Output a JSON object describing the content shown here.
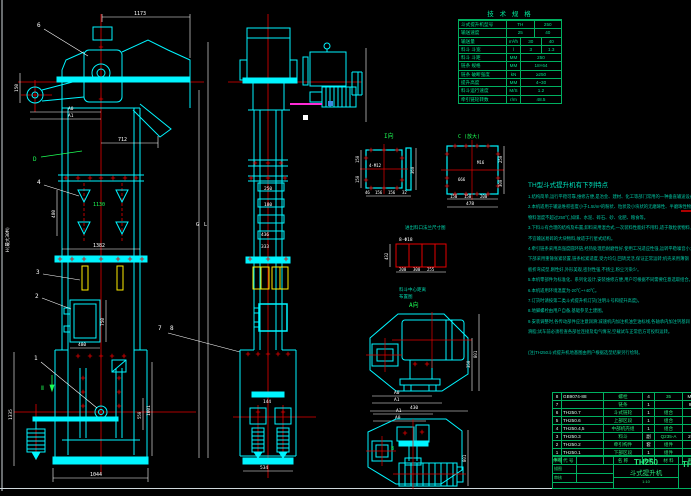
{
  "colors": {
    "cyan": "#00f5ff",
    "red": "#e60000",
    "green": "#1dff55",
    "yellow": "#ffee00",
    "magenta": "#ff2bd6",
    "teal": "#00d8ae",
    "table_green": "#00e08a"
  },
  "spec_table": {
    "title": "技 术 规 格",
    "rows": [
      {
        "l": "斗式提升机型号",
        "u": "",
        "v1": "TH",
        "v2": "250"
      },
      {
        "l": "输送速度",
        "u": "",
        "v1": "25",
        "v2": "40"
      },
      {
        "l": "输送量",
        "u": "m³/h",
        "v1": "30",
        "v2": "40"
      },
      {
        "l": "料斗 斗宽",
        "u": "l",
        "v1": "3",
        "v2": "1.3"
      },
      {
        "l": "料斗 斗距",
        "u": "MM",
        "v1": "250",
        "v2": ""
      },
      {
        "l": "链条 规格",
        "u": "MM",
        "v1": "18×64",
        "v2": ""
      },
      {
        "l": "链条 破断强度",
        "u": "kN",
        "v1": "≥250",
        "v2": ""
      },
      {
        "l": "提升高度",
        "u": "MM",
        "v1": "4~30",
        "v2": ""
      },
      {
        "l": "料斗运行速度",
        "u": "M/S",
        "v1": "1.2",
        "v2": ""
      },
      {
        "l": "牵引链轮转数",
        "u": "r/m",
        "v1": "48.5",
        "v2": ""
      }
    ]
  },
  "notes": {
    "title": "TH型斗式提升机有下列特点",
    "lines": [
      "1.结构简单,运行平稳可靠,维修方便,是冶金、建材、化工等部门常用的一种垂直输送设备。",
      "2.本机适用于输送堆积密度小于1.5t/m³的粉状、粒状及小块状的无磨琢性、半磨琢性物料,",
      "  物料温度不超过250℃,如煤、水泥、碎石、砂、化肥、粮食等。",
      "3.下料斗有合理的结构及布置,卸料采用混合式,一次装料性能好不甩料,适于散粒状物料,",
      "  不宜输送易碎的大块物料,故适于行星式结构。",
      "4.牵引链条采用高强度圆环链,经热处理后耐磨性好,使用工况适应性强,运转平稳噪音小;",
      "  下部采用重锤张紧装置,链条松紧适度,受力均匀,回转灵活,保证正常运转;机壳采用薄钢",
      "  板折弯成型,刚性好,外形美观,密封性强,不扬尘,粉尘污染少。",
      "5.本机零部件为标准化、系列化设计,安装维修方便,用户可根据不同需要任意选取组合。",
      "6.本机适用环境温度为-20℃~+40℃。",
      "7.订货时请按第二类斗式提升机订货(注明斗号和提升高度)。",
      "8.地脚螺栓由用户自备,基础参见土建图。",
      "9.安装调整时,各传动部件应注意润滑:减速机内加注机油至油标线,各轴承内加注钙基润",
      "  滑脂;试车前必须检查各部位连接及电气情况,空载试车正常后方可投料运转。",
      "",
      "(注)TH250斗式提升机地基图由用户根据选型结果另行绘制。"
    ]
  },
  "bom": {
    "header": {
      "no": "件号",
      "code": "代  号",
      "name": "名  称",
      "qty": "数量",
      "mat": "材  料",
      "wt": "重量"
    },
    "rows": [
      {
        "no": "8",
        "code": "GB9074-88",
        "name": "螺栓",
        "qty": "4",
        "mat": "35",
        "wt": "M20"
      },
      {
        "no": "7",
        "code": "",
        "name": "链条",
        "qty": "1",
        "mat": "",
        "wt": "9.0"
      },
      {
        "no": "6",
        "code": "TH250.7",
        "name": "斗式链轮",
        "qty": "1",
        "mat": "组合",
        "wt": ""
      },
      {
        "no": "5",
        "code": "TH250.6",
        "name": "上部区段",
        "qty": "1",
        "mat": "组合",
        "wt": ""
      },
      {
        "no": "4",
        "code": "TH250.4,5",
        "name": "中部机壳组",
        "qty": "1",
        "mat": "组合",
        "wt": ""
      },
      {
        "no": "3",
        "code": "TH250.3",
        "name": "料斗",
        "qty": "副",
        "mat": "Q235-A",
        "wt": "203"
      },
      {
        "no": "2",
        "code": "TH250.2",
        "name": "牵引构件",
        "qty": "套",
        "mat": "组件",
        "wt": ""
      },
      {
        "no": "1",
        "code": "TH250.1",
        "name": "下部区段",
        "qty": "1",
        "mat": "组件",
        "wt": ""
      }
    ]
  },
  "title_block": {
    "model": "TH250",
    "name": "斗式提升机",
    "right_model": "TH2",
    "scale": "1:10",
    "sig_rows": [
      "制图",
      "描图",
      "审核"
    ]
  },
  "balloons": {
    "b1": "1",
    "b2": "2",
    "b3": "3",
    "b4": "4",
    "b6": "6",
    "b7": "7",
    "b8": "8"
  },
  "labels": {
    "view_i": "I向",
    "view_c": "C (放大)",
    "view_a": "A向",
    "view_b": "B",
    "dir_d": "D",
    "dir_ii": "Ⅱ",
    "bolt_grid": "8-Φ18",
    "cap_flange": "进出料口法兰尺寸图",
    "cap_grid_1": "料斗中心距离",
    "cap_grid_2": "布置图",
    "height_note": "H(最大30M)",
    "dim_letter_l": "L",
    "dim_letter_g": "G"
  },
  "dims": {
    "d1173": "1173",
    "d712": "712",
    "dA0": "A0",
    "dA1": "A1",
    "d150": "150",
    "d480": "480",
    "d1130": "1130",
    "d1382": "1382",
    "d750": "750",
    "d480b": "480",
    "d1044": "1044",
    "d1335": "1335",
    "d1001": "1001",
    "d550": "550",
    "s250": "250",
    "s180": "180",
    "s436": "436",
    "s333": "333",
    "s144": "144",
    "s534": "534",
    "i150a": "150",
    "i150b": "150",
    "i360": "360",
    "i46": "46",
    "i156a": "156",
    "i156b": "156",
    "i32": "32",
    "iM": "4-M12",
    "cM": "M16",
    "c666": "666",
    "c250": "250",
    "c300": "300",
    "c150a": "150",
    "c150b": "150",
    "c200": "200",
    "c478": "478",
    "g432": "432",
    "g200": "200",
    "g300": "300",
    "g255": "255",
    "aA0": "A0",
    "aA1": "A1",
    "a430": "430",
    "a350": "350",
    "a801": "801",
    "bA1": "A1",
    "bA0": "A0",
    "b801": "801"
  }
}
